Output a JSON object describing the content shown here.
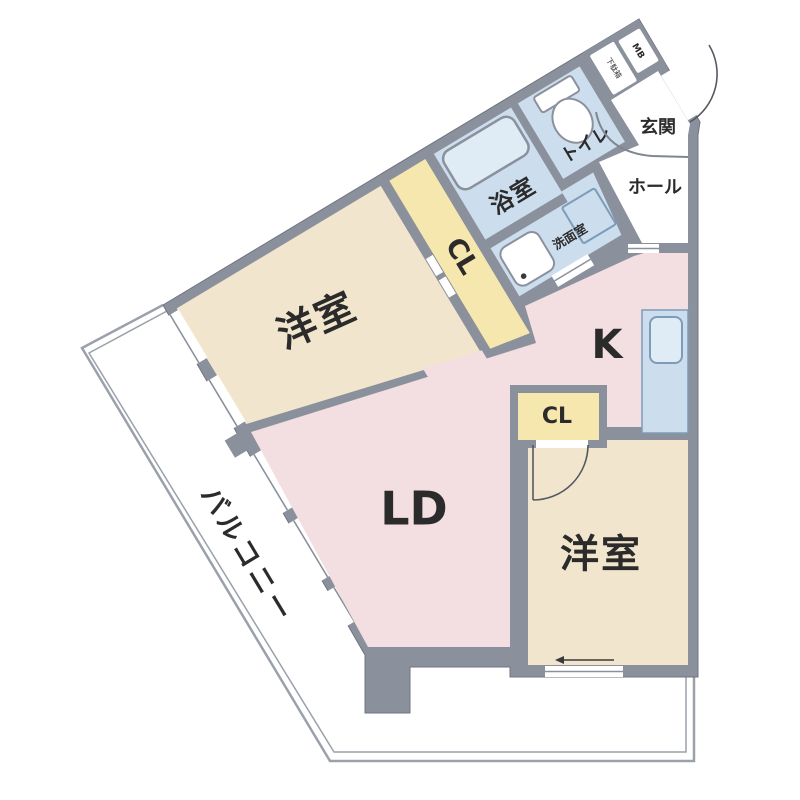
{
  "plan_title": "2LDK apartment floor plan",
  "colors": {
    "wall": "#8b919c",
    "cream": "#f1e5cd",
    "yellow": "#f6e7ae",
    "blue": "#ccdeee",
    "fixture": "#ffffff",
    "tub": "#dfecf6",
    "pink": "#f3dee1",
    "balcony_line": "#9aa1ab",
    "text": "#2b2b2b"
  },
  "rooms": {
    "bedroom1": {
      "label": "洋室"
    },
    "bedroom2": {
      "label": "洋室"
    },
    "living": {
      "label": "LD"
    },
    "kitchen": {
      "label": "K"
    },
    "closet1": {
      "label": "CL"
    },
    "closet2": {
      "label": "CL"
    },
    "bath": {
      "label": "浴室"
    },
    "toilet": {
      "label": "トイレ"
    },
    "washroom": {
      "label": "洗面室"
    },
    "entrance": {
      "label": "玄関"
    },
    "hall": {
      "label": "ホール"
    },
    "balcony": {
      "label": "バルコニー"
    },
    "meter_box": {
      "label": "MB"
    },
    "shoe_box": {
      "label": "下駄箱"
    }
  }
}
